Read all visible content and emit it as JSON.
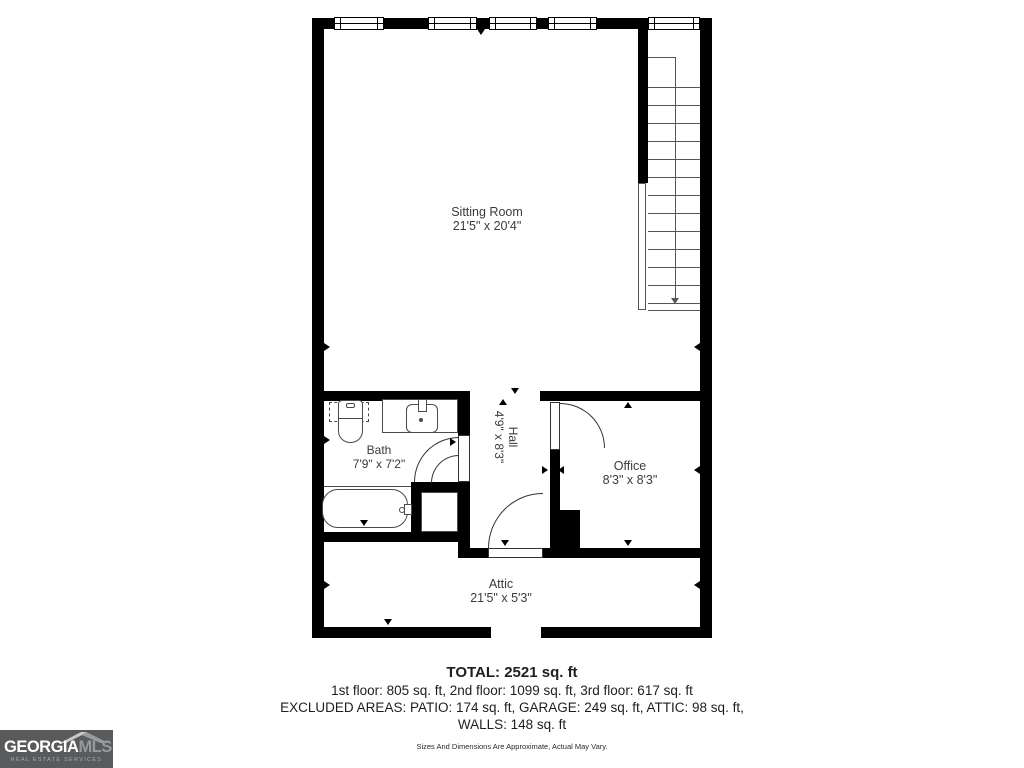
{
  "rooms": [
    {
      "name": "Sitting Room",
      "dims": "21'5\" x 20'4\""
    },
    {
      "name": "Bath",
      "dims": "7'9\" x 7'2\""
    },
    {
      "name": "Hall",
      "dims": "4'9\" x 8'3\""
    },
    {
      "name": "Office",
      "dims": "8'3\" x 8'3\""
    },
    {
      "name": "Attic",
      "dims": "21'5\" x 5'3\""
    }
  ],
  "summary": {
    "total": "TOTAL: 2521 sq. ft",
    "floors": "1st floor: 805 sq. ft, 2nd floor: 1099 sq. ft, 3rd floor: 617 sq. ft",
    "excluded": "EXCLUDED AREAS: PATIO: 174 sq. ft, GARAGE: 249 sq. ft, ATTIC: 98 sq. ft,",
    "walls": "WALLS: 148 sq. ft",
    "disclaimer": "Sizes And Dimensions Are Approximate, Actual May Vary."
  },
  "logo": {
    "brand_primary": "GEORGIA",
    "brand_secondary": "MLS",
    "tagline": "REAL ESTATE SERVICES"
  },
  "colors": {
    "wall": "#000000",
    "label_text": "#3b3b3b",
    "logo_bg": "#595a5c"
  }
}
